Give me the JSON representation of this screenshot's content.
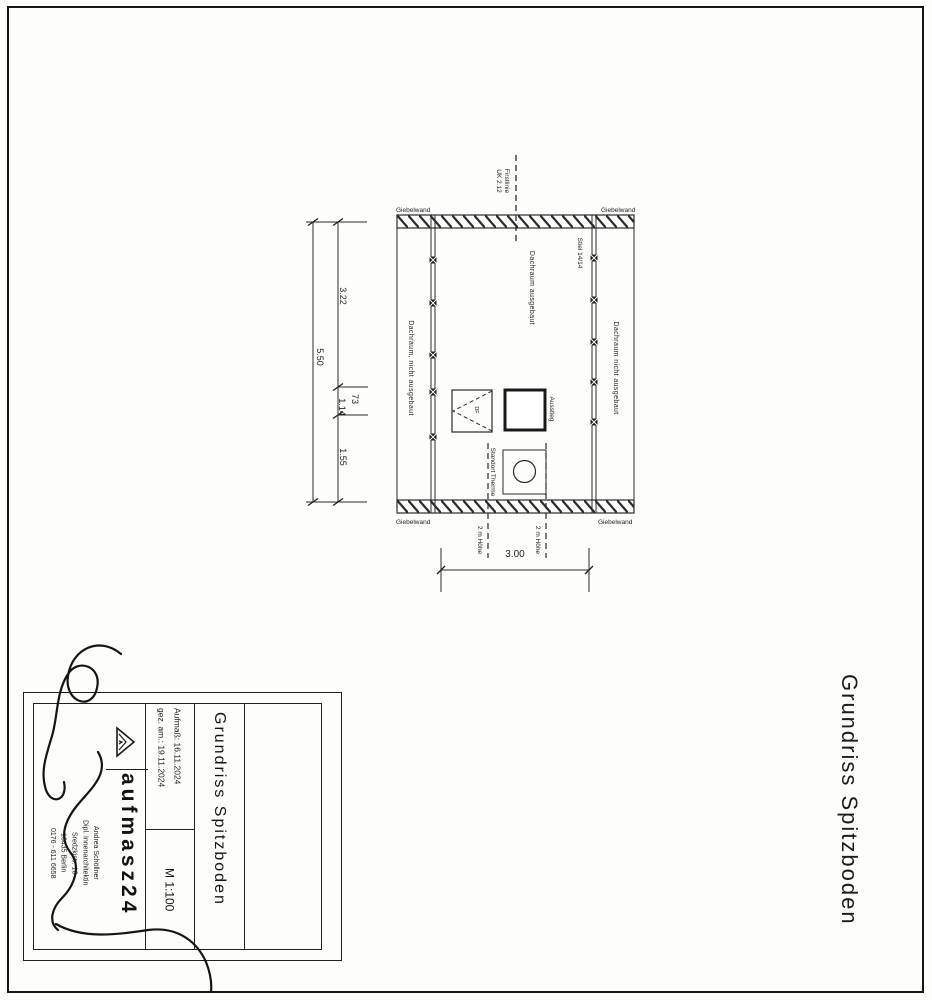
{
  "side_title": "Grundriss Spitzboden",
  "plan": {
    "labels": {
      "giebelwand": "Giebelwand",
      "firstlinie_line1": "Firstlinie",
      "firstlinie_line2": "UK 2.12",
      "stiel": "Stiel 14/14",
      "room_left": "Dachraum, nicht ausgebaut",
      "room_center": "Dachraum ausgebaut",
      "room_right": "Dachraum nicht ausgebaut",
      "roof_window": "DF",
      "ausstieg": "Ausstieg",
      "therme": "Standort Therme",
      "height_2m": "2 m Höhe"
    },
    "dimensions": {
      "total_depth": "5.50",
      "seg_top": "3.22",
      "seg_73": "73",
      "seg_114": "1.14",
      "seg_bottom": "1.55",
      "width": "3.00"
    }
  },
  "title_block": {
    "drawing_title": "Grundriss Spitzboden",
    "aufmass": "Aufmaß: 16.11.2024",
    "gez_am": "gez. am.: 19.11.2024",
    "scale": "M 1:100",
    "brand": "aufmasz24",
    "name": "Andrea Schöllner",
    "profession": "Dipl. Innenarchitektin",
    "street": "Sredzkistr. 16",
    "city": "10435 Berlin",
    "phone": "0176 - 611 6658"
  }
}
